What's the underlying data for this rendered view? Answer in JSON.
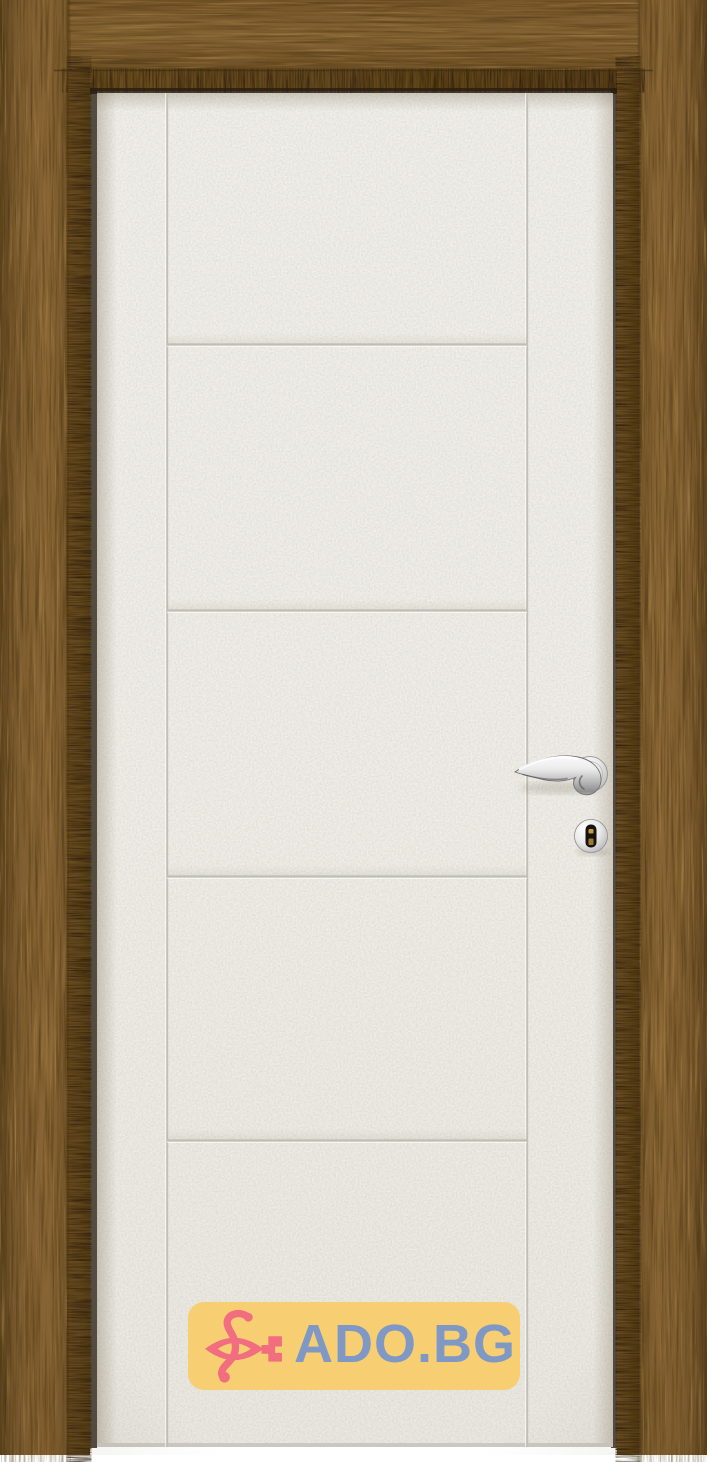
{
  "product_photo": {
    "subject": "white-interior-door-in-wood-frame",
    "door_color": "#f1efe9",
    "frame_wood_color": "#7b5a2e",
    "frame_inner_band_color": "#63471f",
    "groove_line_color": "#c6c3bb",
    "horizontal_grooves_count": 4,
    "vertical_grooves_count": 2,
    "hardware": [
      "chrome-lever-handle",
      "chrome-keyhole-escutcheon"
    ],
    "hardware_finish_color": "#c9c9c9",
    "keyhole_color": "#171310",
    "keyhole_pin_color": "#c79a3f"
  },
  "watermark": {
    "text": "ADO.BG",
    "background_color": "#f8cf6e",
    "text_color": "#7b95c4",
    "logo_color": "#f2697c"
  }
}
